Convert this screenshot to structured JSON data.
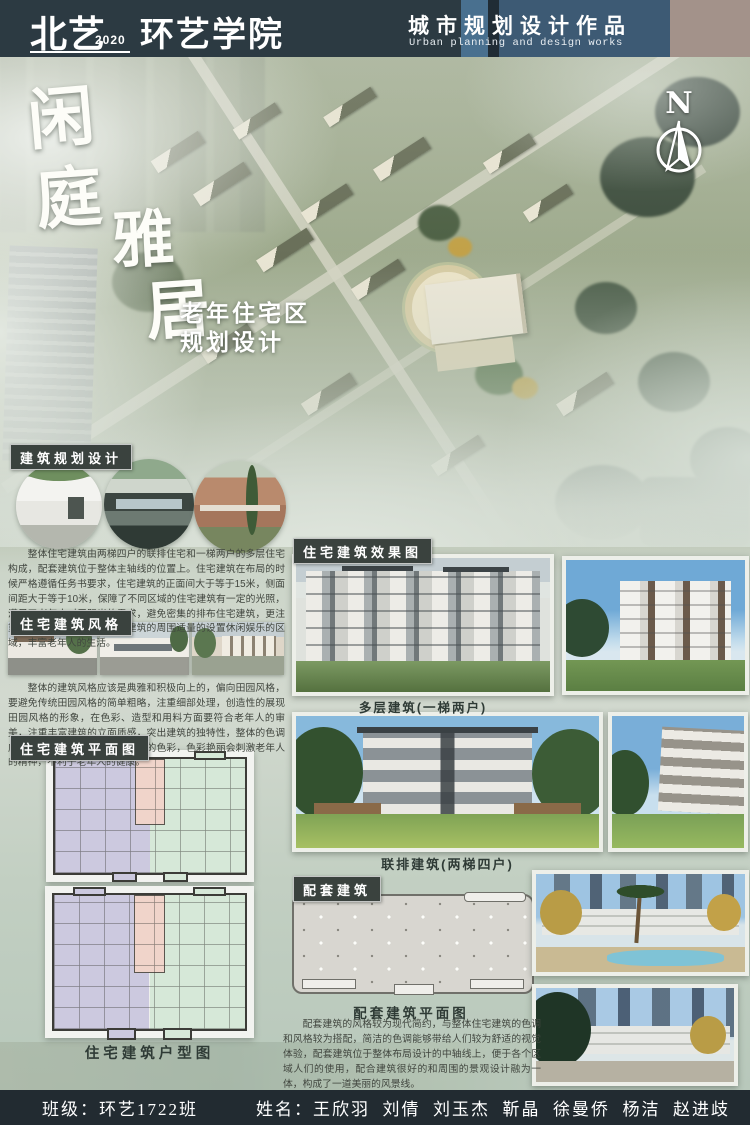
{
  "header": {
    "school": "北艺",
    "year": "2020",
    "college": "环艺学院",
    "title_cn": "城市规划设计作品",
    "title_en": "Urban planning and design works"
  },
  "hero": {
    "calligraphy_char1": "闲",
    "calligraphy_char2": "庭",
    "calligraphy_char3": "雅",
    "calligraphy_char4": "居",
    "subtitle_line1": "老年住宅区",
    "subtitle_line2": "规划设计",
    "compass_label": "N"
  },
  "sections": {
    "planning": {
      "label": "建筑规划设计",
      "paragraph": "整体住宅建筑由两梯四户的联排住宅和一梯两户的多层住宅构成，配套建筑位于整体主轴线的位置上。住宅建筑在布局的时候严格遵循任务书要求，住宅建筑的正面间大于等于15米，侧面间距大于等于10米，保障了不同区域的住宅建筑有一定的光照，满足了老年人对于阳光的需求，避免密集的排布住宅建筑，更注重空间舒适感的营造，住宅建筑的周围适量的设置休闲娱乐的区域，丰富老年人的生活。"
    },
    "style": {
      "label": "住宅建筑风格",
      "paragraph": "整体的建筑风格应该是典雅和积极向上的，偏向田园风格，要避免传统田园风格的简单粗略，注重细部处理，创造性的展现田园风格的形象，在色彩、造型和用料方面要符合老年人的审美，注重丰富建筑的立面质感，突出建筑的独特性，整体的色调应以淡雅为主，不宜用过于鲜艳的色彩，色彩艳丽会刺激老年人的精神，不利于老年人的健康。"
    },
    "floorplan": {
      "label": "住宅建筑平面图",
      "caption": "住宅建筑户型图"
    },
    "renderings": {
      "label": "住宅建筑效果图",
      "caption_multistorey": "多层建筑(一梯两户)",
      "caption_townhouse": "联排建筑(两梯四户)"
    },
    "amenity": {
      "label": "配套建筑",
      "plan_caption": "配套建筑平面图",
      "paragraph": "配套建筑的风格较为现代简约，与整体住宅建筑的色调和风格较为搭配，简洁的色调能够带给人们较为舒适的视觉体验，配套建筑位于整体布局设计的中轴线上，便于各个区域人们的使用，配合建筑很好的和周围的景观设计融为一体，构成了一道美丽的风景线。"
    }
  },
  "footer": {
    "class_text": "班级：环艺1722班",
    "names_text": "姓名：王欣羽  刘倩  刘玉杰  靳晶  徐曼侨  杨洁  赵进歧"
  },
  "colors": {
    "header_bg": "#2c3a42",
    "header_panel_blue": "#3d5a74",
    "header_accent_taupe": "#a3928a",
    "label_bg": "#3a423e",
    "footer_bg": "#222b31",
    "plan_lavender": "#ccc9df",
    "plan_mint": "#d6e8d8",
    "plan_pink": "#f0d4ca"
  }
}
